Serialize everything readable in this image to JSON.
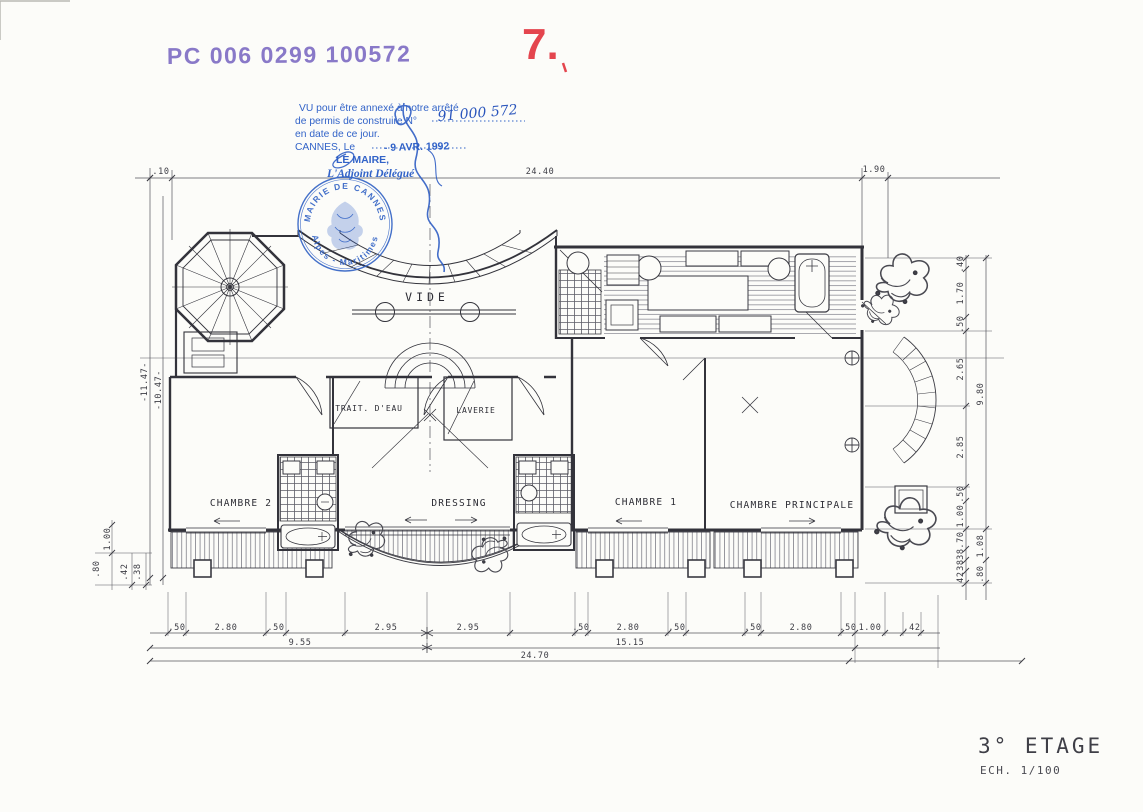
{
  "document": {
    "registration_stamp": "PC 006 0299 100572",
    "sheet_number": "7.",
    "title": "3° ETAGE",
    "scale": "ECH. 1/100"
  },
  "approval_stamp": {
    "line1": "VU pour être annexé à notre arrêté",
    "line2": "de permis de construire N°",
    "permit_number_handwritten": "91 000 572",
    "line3": "en date de ce jour.",
    "line4": "CANNES, Le",
    "date_stamp": "- 9 AVR. 1992",
    "line5": "LE MAIRE,",
    "line6": "L'Adjoint Délégué",
    "seal": {
      "top": "★ MAIRIE DE CANNES ★",
      "bottom": "( Alpes - Maritimes )"
    }
  },
  "rooms": {
    "vide": "VIDE",
    "trait_eau": "TRAIT. D'EAU",
    "laverie": "LAVERIE",
    "chambre2": "CHAMBRE 2",
    "dressing": "DRESSING",
    "chambre1": "CHAMBRE 1",
    "chambre_principale": "CHAMBRE PRINCIPALE"
  },
  "dimensions": {
    "top": [
      ".10",
      "24.40",
      "1.90"
    ],
    "left": [
      "-11.47-",
      "-10.47-",
      "1.00",
      ".80",
      ".42",
      ".38"
    ],
    "right": [
      ".40",
      "1.70",
      ".50",
      "2.65",
      "2.85",
      ".50",
      "1.00",
      ".70",
      ".38",
      ".38",
      ".42",
      "9.80",
      "1.08",
      ".80"
    ],
    "bottom_row1": [
      ".50",
      "2.80",
      ".50",
      "2.95",
      "2.95",
      ".50",
      "2.80",
      ".50",
      ".50",
      "2.80",
      ".50",
      "1.00",
      ".42"
    ],
    "bottom_row2": [
      "9.55",
      "15.15"
    ],
    "bottom_total": "24.70"
  }
}
